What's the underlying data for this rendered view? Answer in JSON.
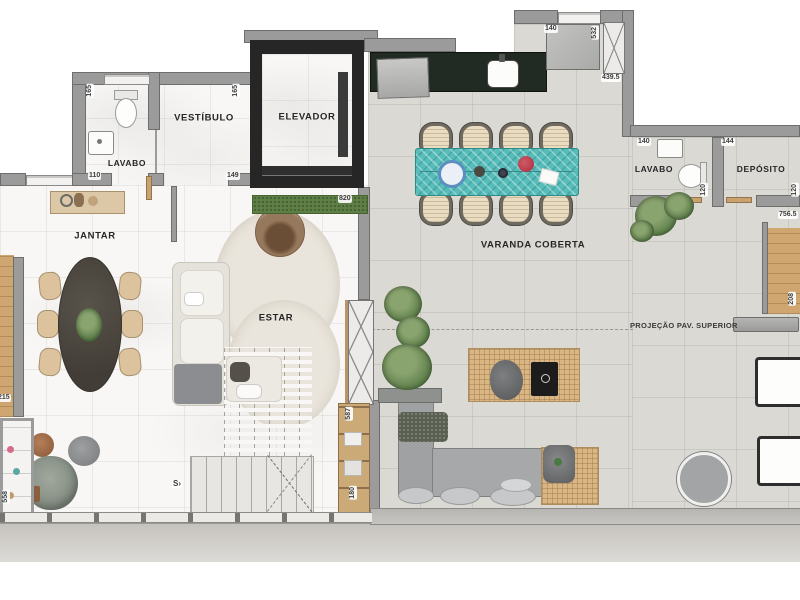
{
  "labels": {
    "lavabo1": "LAVABO",
    "vestibulo": "VESTÍBULO",
    "elevador": "ELEVADOR",
    "jantar": "JANTAR",
    "estar": "ESTAR",
    "varanda": "VARANDA COBERTA",
    "lavabo2": "LAVABO",
    "deposito": "DEPÓSITO",
    "projecao": "PROJEÇÃO PAV. SUPERIOR"
  },
  "dims": {
    "lavabo1_height": "165",
    "vestibulo_height": "165",
    "lavabo1_width": "110",
    "vestibulo_width": "149",
    "planter_width": "820",
    "kitchen_opening": "140",
    "shaft_height": "532",
    "varanda_top": "439.5",
    "lavabo2_width": "140",
    "deposito_width": "144",
    "lavabo2_height": "120",
    "deposito_height": "120",
    "deck_width": "756.5",
    "deck_height": "208",
    "left_bench": "215",
    "left_cabinet": "558",
    "shelf_upper": "587",
    "shelf_lower": "180"
  },
  "stairs": {
    "direction": "S",
    "arrow": "›"
  },
  "colors": {
    "wall": "#9b9b9b",
    "wall_dark": "#262626",
    "tile_floor": "#dbd9d4",
    "marble_floor": "#f8f7f5",
    "counter": "#222a24",
    "table_teal": "#57bdba",
    "wood": "#cfa670",
    "grass": "#5d7f46",
    "flower_red": "#b63a4a",
    "plate_blue": "#5b8fc0"
  }
}
